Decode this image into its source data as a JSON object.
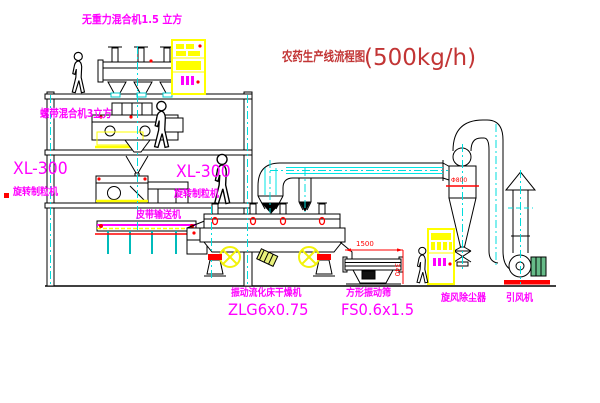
{
  "title": {
    "name": "农药生产线流程图",
    "capacity": "(500kg/h)"
  },
  "equipment_labels": {
    "gravity_mixer": "无重力混合机1.5 立方",
    "ribbon_mixer": "螺带混合机3立方",
    "granulator_left_model": "XL-300",
    "granulator_left_name": "旋转制粒机",
    "granulator_mid_model": "XL-300",
    "granulator_mid_name": "旋转制粒机",
    "belt_conveyor": "皮带输送机",
    "fluid_bed_dryer_name": "振动流化床干燥机",
    "fluid_bed_dryer_model": "ZLG6x0.75",
    "vibrating_screen_name": "方形振动筛",
    "vibrating_screen_model": "FS0.6x1.5",
    "cyclone_collector": "旋风除尘器",
    "induced_draft_fan": "引风机"
  },
  "dimensions": {
    "screen_length": "1500",
    "screen_height": "340",
    "cyclone_diameter": "Φ800"
  },
  "colors": {
    "label_magenta": "#ff00ff",
    "title_red": "#c23535",
    "line_black": "#000000",
    "centerline_cyan": "#00dddd",
    "accent_yellow": "#ffff00",
    "accent_red": "#ff0000"
  }
}
